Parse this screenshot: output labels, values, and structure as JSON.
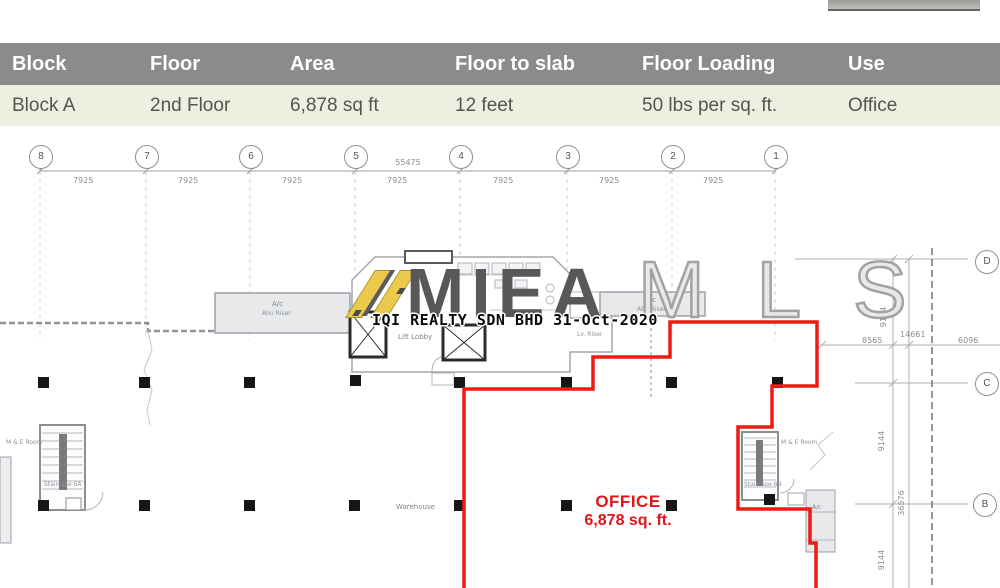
{
  "table": {
    "headers": [
      "Block",
      "Floor",
      "Area",
      "Floor to slab",
      "Floor Loading",
      "Use"
    ],
    "row": [
      "Block A",
      "2nd Floor",
      "6,878 sq ft",
      "12 feet",
      "50 lbs per sq. ft.",
      "Office"
    ]
  },
  "grid": {
    "top_bubbles": [
      "8",
      "7",
      "6",
      "5",
      "4",
      "3",
      "2",
      "1"
    ],
    "spacings": [
      "7925",
      "7925",
      "7925",
      "7925",
      "7925",
      "7925",
      "7925"
    ],
    "overall": "55475",
    "right_bubbles": [
      "D",
      "C",
      "B"
    ]
  },
  "dims": {
    "right": [
      "9144",
      "14661",
      "8565",
      "6096",
      "9144",
      "36576",
      "9144"
    ]
  },
  "plan": {
    "ac_label": "A/c",
    "ahu_label": "Ahu Riser",
    "lift_lobby": "Lift Lobby",
    "lv_riser": "Lv. Riser",
    "staircase_a": "Staircase 6A",
    "staircase_b": "Staircase 6B",
    "me_room": "M & E Room",
    "warehouse": "Warehouse",
    "office_line1": "OFFICE",
    "office_line2": "6,878 sq. ft."
  },
  "watermark": {
    "brand_solid": "MIEA",
    "brand_outline": "MLS",
    "stamp": "IQI REALTY SDN BHD 31-Oct-2020"
  },
  "colors": {
    "boundary_red": "#ec1c13",
    "table_header_bg": "#8b8b89",
    "table_row_bg": "#edf0e1",
    "watermark_yellow": "#eac94d"
  }
}
